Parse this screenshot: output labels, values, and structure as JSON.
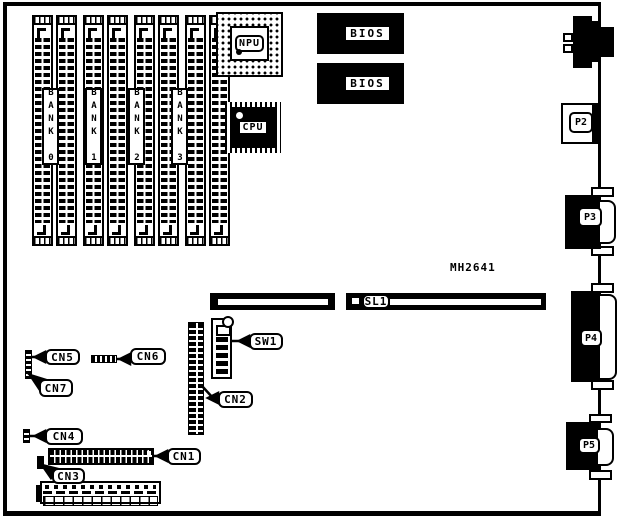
{
  "board": {
    "code": "MH2641"
  },
  "banks": [
    {
      "label": "BANK 0"
    },
    {
      "label": "BANK 1"
    },
    {
      "label": "BANK 2"
    },
    {
      "label": "BANK 3"
    }
  ],
  "chips": {
    "npu": "NPU",
    "cpu": "CPU",
    "bios_top": "BIOS",
    "bios_bottom": "BIOS"
  },
  "connectors": {
    "cn1": "CN1",
    "cn2": "CN2",
    "cn3": "CN3",
    "cn4": "CN4",
    "cn5": "CN5",
    "cn6": "CN6",
    "cn7": "CN7",
    "sw1": "SW1",
    "sl1": "SL1",
    "p2": "P2",
    "p3": "P3",
    "p4": "P4",
    "p5": "P5"
  },
  "colors": {
    "ink": "#000000",
    "paper": "#ffffff"
  }
}
